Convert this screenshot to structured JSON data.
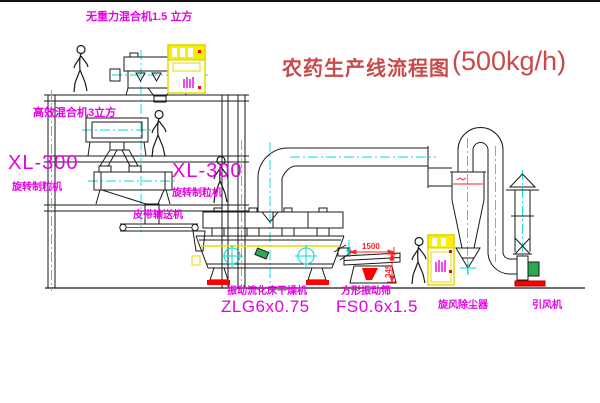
{
  "title": {
    "cn": "农药生产线流程图",
    "capacity": "(500kg/h)"
  },
  "labels": {
    "gravity_mixer": "无重力混合机1.5 立方",
    "mixer2": "高效混合机3立方",
    "granulator_left_model": "XL-300",
    "granulator_left_name": "旋转制粒机",
    "granulator_mid_model": "XL-300",
    "granulator_mid_name": "旋转制粒机",
    "belt_conveyor": "皮带输送机",
    "dryer_name": "振动流化床干燥机",
    "dryer_model": "ZLG6x0.75",
    "screen_name": "方形振动筛",
    "screen_model": "FS0.6x1.5",
    "cyclone": "旋风除尘器",
    "fan": "引风机"
  },
  "dimensions": {
    "screen_length": "1500",
    "screen_height": "345"
  },
  "colors": {
    "label_magenta": "#e600e6",
    "title_red": "#c84a4a",
    "accent_yellow": "#f0f000",
    "centerline_cyan": "#00dcdc",
    "machine_green": "#2ea84f",
    "alert_red": "#ff0000",
    "line_black": "#1a1a1a"
  }
}
